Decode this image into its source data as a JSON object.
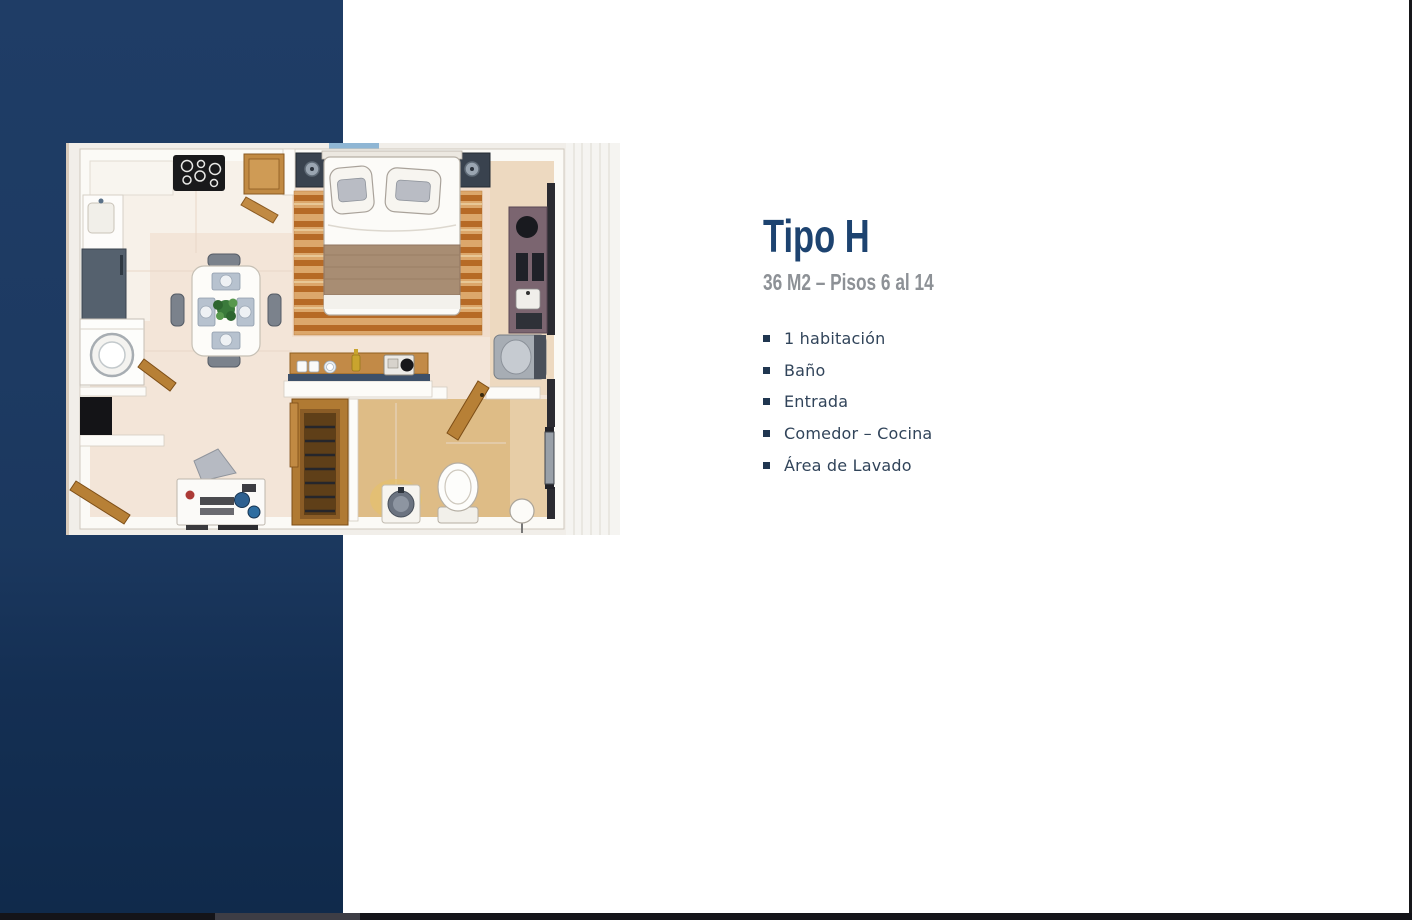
{
  "page": {
    "background": "#ffffff"
  },
  "accent_band": {
    "color_top": "#1f3d66",
    "color_bottom": "#102a4b"
  },
  "panel": {
    "title": "Tipo H",
    "subtitle": "36 M2 – Pisos 6 al 14",
    "title_color": "#1d4370",
    "subtitle_color": "#8d9196",
    "text_color": "#31445a",
    "bullet_icon": "square-bullet",
    "features": [
      "1 habitación",
      "Baño",
      "Entrada",
      "Comedor – Cocina",
      "Área de Lavado"
    ]
  },
  "floorplan": {
    "name": "apartment-floorplan-top-view",
    "description": "Watercolor top-view floor plan of a one-bedroom apartment with bed, dining table, kitchen, bathroom, closet and laundry area"
  },
  "scrollbar": {
    "track_color": "#141419",
    "thumb_color": "#3d3d45"
  }
}
